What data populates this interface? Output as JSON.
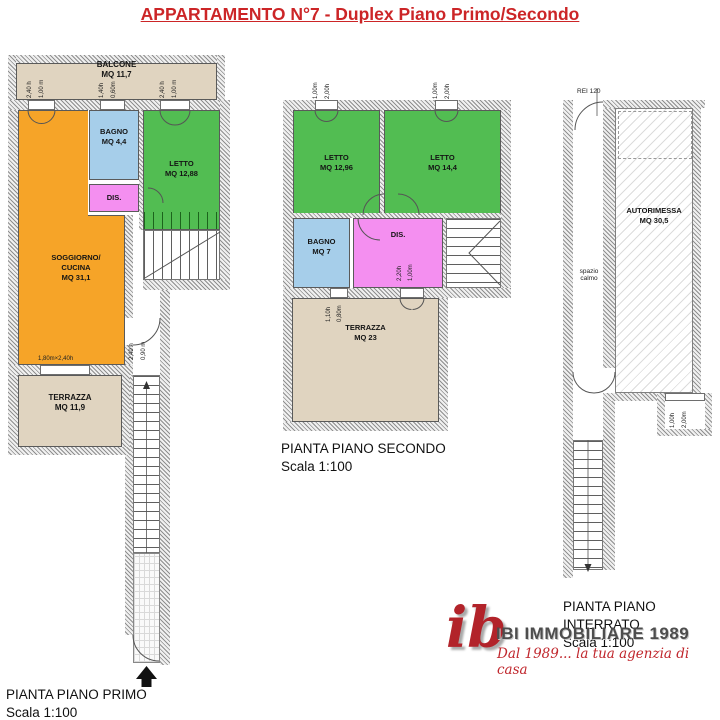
{
  "title": "APPARTAMENTO N°7 - Duplex Piano Primo/Secondo",
  "primo": {
    "caption": "PIANTA PIANO PRIMO",
    "scale": "Scala 1:100",
    "balcone": {
      "name": "BALCONE",
      "area": "MQ 11,7"
    },
    "bagno": {
      "name": "BAGNO",
      "area": "MQ 4,4"
    },
    "letto": {
      "name": "LETTO",
      "area": "MQ 12,88"
    },
    "dis": {
      "name": "DIS."
    },
    "soggiorno": {
      "line1": "SOGGIORNO/",
      "line2": "CUCINA",
      "area": "MQ 31,1"
    },
    "terrazza": {
      "name": "TERRAZZA",
      "area": "MQ 11,9"
    },
    "dims": {
      "winL_h": "2,40 h",
      "winL_w": "1,00 m",
      "winM_h": "1,40h",
      "winM_w": "0,60m",
      "winR_h": "2,40 h",
      "winR_w": "1,00 m",
      "winBottom": "1,80m×2,40h",
      "door_h": "2,40 h",
      "door_w": "0,90 m"
    }
  },
  "secondo": {
    "caption": "PIANTA PIANO SECONDO",
    "scale": "Scala 1:100",
    "letto1": {
      "name": "LETTO",
      "area": "MQ 12,96"
    },
    "letto2": {
      "name": "LETTO",
      "area": "MQ 14,4"
    },
    "bagno": {
      "name": "BAGNO",
      "area": "MQ 7"
    },
    "dis": {
      "name": "DIS."
    },
    "terrazza": {
      "name": "TERRAZZA",
      "area": "MQ 23"
    },
    "dims": {
      "win1_w": "1,00m",
      "win1_h": "2,00h",
      "win2_w": "1,00m",
      "win2_h": "2,00h",
      "bagnoWin_h": "1,10h",
      "bagnoWin_w": "0,80m",
      "door_h": "2,20h",
      "door_w": "1,00m"
    }
  },
  "interrato": {
    "caption": "PIANTA PIANO INTERRATO",
    "scale": "Scala 1:100",
    "rei": "REI 120",
    "autorimessa": {
      "name": "AUTORIMESSA",
      "area": "MQ 30,5"
    },
    "spazio": {
      "line1": "spazio",
      "line2": "calmo"
    },
    "dims": {
      "win_h": "1,00h",
      "win_w": "2,00m"
    }
  },
  "logo": {
    "monogram": "ib",
    "name": "IBI IMMOBILIARE 1989",
    "tagline": "Dal 1989... la tua agenzia di casa"
  },
  "colors": {
    "accent_red": "#cc2527",
    "room_orange": "#f6a428",
    "room_green": "#52bd52",
    "room_blue": "#a6ceea",
    "room_pink": "#f48ff0",
    "outdoor_beige": "#e0d4c0",
    "logo_red": "#b2232a"
  }
}
